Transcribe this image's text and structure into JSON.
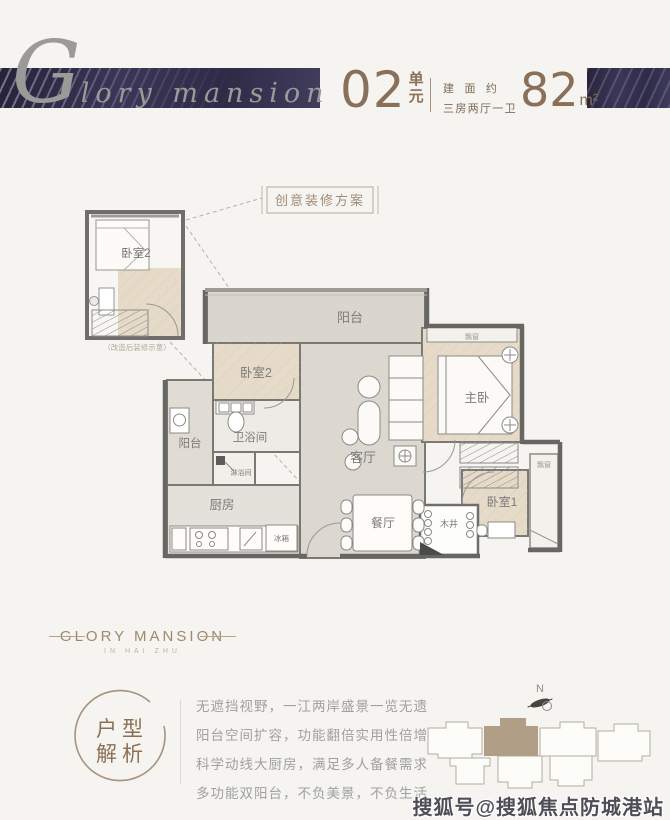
{
  "header": {
    "script_title": "Glory mansion",
    "unit_number": "02",
    "unit_suffix": "单元",
    "area_note_top": "建面约",
    "area_note_bottom": "三房两厅一卫",
    "area_value": "82",
    "area_unit": "m²"
  },
  "plan": {
    "scheme_label": "创意装修方案",
    "inset": {
      "room": "卧室2",
      "caption": "（改造后装修示意）"
    },
    "rooms": {
      "balcony_top": "阳台",
      "bedroom2": "卧室2",
      "bathroom": "卫浴间",
      "shower": "淋浴间",
      "balcony_left": "阳台",
      "kitchen": "厨房",
      "fridge": "冰箱",
      "living": "客厅",
      "dining": "餐厅",
      "master": "主卧",
      "bedroom1": "卧室1",
      "well": "木井",
      "bay_master": "飘窗",
      "bay_bedroom1": "飘窗"
    }
  },
  "footer": {
    "brand": "GLORY MANSION",
    "brand_sub": "IN HAI ZHU",
    "stamp_line1": "户型",
    "stamp_line2": "解析",
    "paragraph": [
      "无遮挡视野，一江两岸盛景一览无遗",
      "阳台空间扩容，功能翻倍实用性倍增",
      "科学动线大厨房，满足多人备餐需求",
      "多功能双阳台，不负美景，不负生活"
    ],
    "compass_label": "N"
  },
  "watermark": "搜狐号@搜狐焦点防城港站",
  "colors": {
    "banner": "#34304d",
    "bronze": "#8a7058",
    "wall": "#6f6e6c",
    "wood_floor": "#e6dbc8",
    "tile_floor": "#dcd8cf",
    "site_highlight": "#b19e87"
  }
}
